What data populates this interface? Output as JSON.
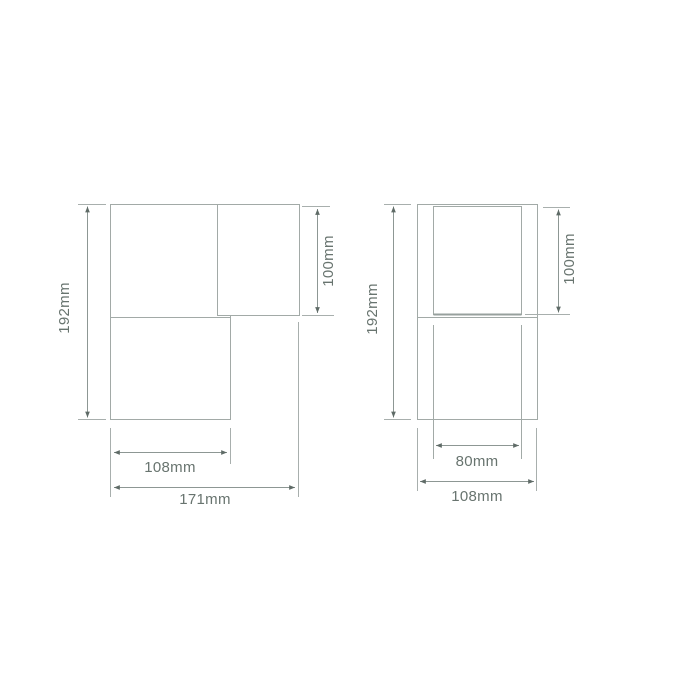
{
  "diagram": {
    "type": "technical-dimension-drawing",
    "background_color": "#ffffff",
    "line_color": "#a2aaa7",
    "dimension_line_color": "#8d9794",
    "arrow_color": "#5f6b67",
    "label_color": "#68746f",
    "figures": {
      "left": {
        "overall_height": "192mm",
        "cylinder_height": "100mm",
        "body_width": "108mm",
        "overall_depth": "171mm"
      },
      "right": {
        "overall_height": "192mm",
        "cylinder_height": "100mm",
        "cylinder_width": "80mm",
        "overall_width": "108mm"
      }
    }
  }
}
